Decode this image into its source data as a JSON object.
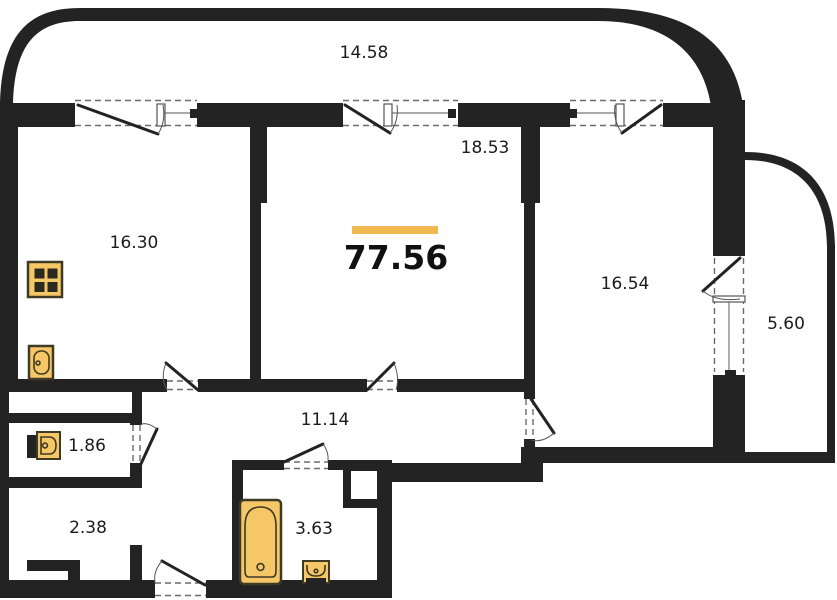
{
  "plan": {
    "type": "apartment-floor-plan",
    "total_area": "77.56",
    "labels": {
      "balcony_top": "14.58",
      "kitchen": "16.30",
      "living": "18.53",
      "bedroom": "16.54",
      "balcony_right": "5.60",
      "hall": "11.14",
      "wc": "1.86",
      "storage": "2.38",
      "bathroom": "3.63"
    },
    "colors": {
      "wall": "#232323",
      "fixture": "#F6C766",
      "fixture_stroke": "#3E3A26",
      "accent": "#F1B94F",
      "text": "#1B1B1B"
    }
  }
}
